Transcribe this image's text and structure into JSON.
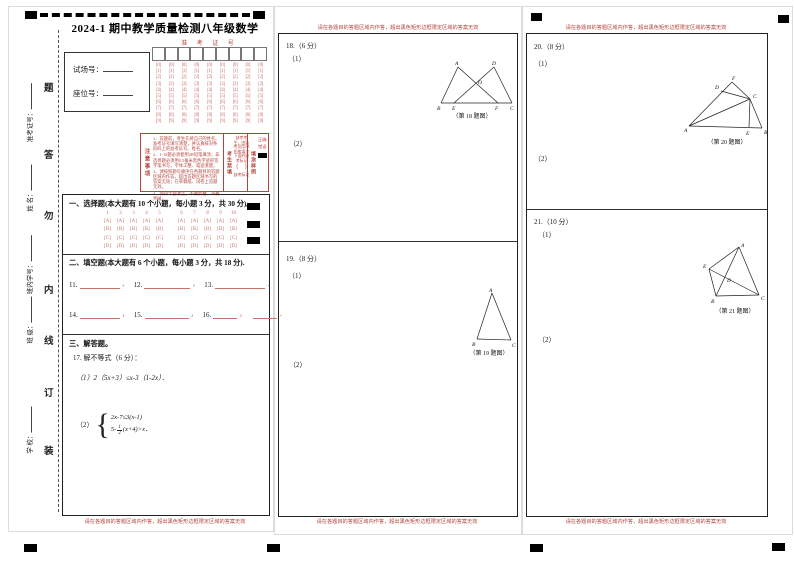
{
  "page": {
    "title": "2024-1 期中教学质量检测八年级数学",
    "red_note": "请在各题目的答题区域内作答，超出黑色矩形边框限定区域的答案无效",
    "binding_chars": [
      "题",
      "答",
      "勿",
      "内",
      "线",
      "订",
      "装"
    ],
    "binding_labels": [
      "准考证号：",
      "姓 名：",
      "班内学号：",
      "班 级：",
      "学 校："
    ]
  },
  "id_box": {
    "exam_room_label": "试场号：",
    "seat_label": "座位号："
  },
  "exam_no_grid": {
    "header": "准 考 证 号",
    "columns": 9,
    "digits": [
      "0",
      "1",
      "2",
      "3",
      "4",
      "5",
      "6",
      "7",
      "8",
      "9"
    ]
  },
  "notice": {
    "title_vertical": "注意事项",
    "items": [
      "1、答题前，考生先将自己的姓名、准考证号填写清楚，并认真核对条形码上的准考证号、姓名。",
      "2、1-10题必须使用2B铅笔填涂；非选择题必须用0.5毫米黑色字迹的签字笔书写，字体工整、笔迹清楚。",
      "3、请按照题号顺序在各题目的答题区域内作答，超出答题区域书写的答案无效；在草稿纸、试卷上答题无效。",
      "4、保持卡面清洁，不要折叠、不要弄破。"
    ],
    "forbid_vertical": "考生禁填",
    "absent_text": "缺考考生，由监考员用2B铅笔填涂下面的缺考标记",
    "absent_mark": "（　）",
    "absent_mark_label": "缺考标记",
    "sample_vertical": "填涂样例",
    "correct_label": "正确",
    "wrong_label": "错误"
  },
  "sections": {
    "choice": {
      "title": "一、选择题(本大题有 10 个小题，每小题 3 分，共 30 分)。",
      "numbers": [
        "1",
        "2",
        "3",
        "4",
        "5",
        "6",
        "7",
        "8",
        "9",
        "10"
      ],
      "options": [
        "A",
        "B",
        "C",
        "D"
      ]
    },
    "blank": {
      "title": "二、填空题(本大题有 6 个小题，每小题 3 分，共 18 分).",
      "row1": [
        "11.",
        "12.",
        "13."
      ],
      "row2": [
        "14.",
        "15.",
        "16."
      ]
    },
    "solve": {
      "title": "三、解答题。",
      "q17_label": "17. 解不等式（6 分）：",
      "q17_part1": "（1）2（5x+3）≤x-3（1-2x）．",
      "q17_part2_label": "（2）",
      "sys_line1": "2x-7≤3(x-1)",
      "sys_l2_pre": "5-",
      "sys_l2_num": "1",
      "sys_l2_den": "2",
      "sys_l2_post": "(x+4)>x．"
    }
  },
  "questions": {
    "q18": {
      "head": "18.（6 分）",
      "p1": "（1）",
      "p2": "（2）",
      "caption": "（第 18 题图）",
      "labels": [
        "A",
        "D",
        "O",
        "B",
        "E",
        "F",
        "C"
      ]
    },
    "q19": {
      "head": "19.（8 分）",
      "p1": "（1）",
      "p2": "（2）",
      "caption": "（第 19 题图）",
      "labels": [
        "A",
        "B",
        "C"
      ]
    },
    "q20": {
      "head": "20.（8 分）",
      "p1": "（1）",
      "p2": "（2）",
      "caption": "（第 20 题图）",
      "labels": [
        "F",
        "D",
        "C",
        "A",
        "E",
        "B"
      ]
    },
    "q21": {
      "head": "21.（10 分）",
      "p1": "（1）",
      "p2": "（2）",
      "caption": "（第 21 题图）",
      "labels": [
        "A",
        "E",
        "D",
        "B",
        "C"
      ]
    }
  },
  "colors": {
    "print_red": "#b5433b",
    "bubble_red": "#c4736b",
    "ink_black": "#1c1c1c"
  }
}
